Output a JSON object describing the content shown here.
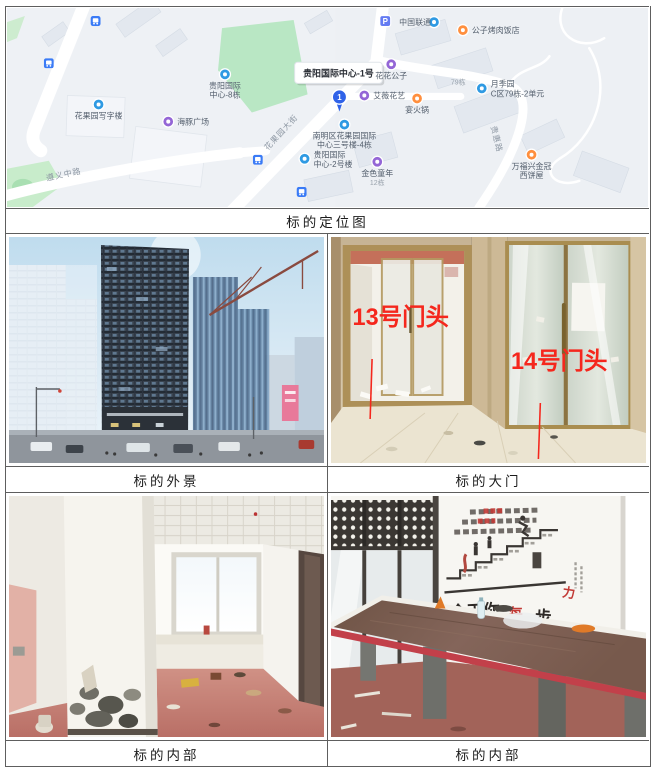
{
  "captions": {
    "map": "标的定位图",
    "exterior": "标的外景",
    "gate": "标的大门",
    "interior_left": "标的内部",
    "interior_right": "标的内部"
  },
  "map": {
    "main_label": "贵阳国际中心-1号",
    "pin_number": "1",
    "roads": {
      "zunyi": "遵义中路",
      "huaguoyuan": "花果园大街",
      "guihui": "贵惠路"
    },
    "pois": {
      "unicom": "中国联通",
      "parking": "P",
      "bbq": "公子烤肉饭店",
      "huahua": "花花公子",
      "florist": "艾薇花艺",
      "hotpot": "宴火锅",
      "yueji_line1": "月季园",
      "yueji_line2": "C区79栋-2单元",
      "block79": "79栋",
      "intl8_line1": "贵阳国际",
      "intl8_line2": "中心-8栋",
      "office": "花果园写字楼",
      "dolphin": "海豚广场",
      "nanming_line1": "南明区花果园国际",
      "nanming_line2": "中心三号楼-4栋",
      "intl2_line1": "贵阳国际",
      "intl2_line2": "中心-2号楼",
      "golden": "金色童年",
      "block12": "12栋",
      "bakery_line1": "万福兴金冠",
      "bakery_line2": "西饼屋"
    }
  },
  "gate": {
    "door13": "13号门头",
    "door14": "14号门头"
  },
  "meeting": {
    "slogan_main": "今天你",
    "slogan_mid": "每",
    "slogan_step": "步",
    "slogan_power": "力"
  },
  "colors": {
    "annotation_red": "#f5271d",
    "map_pin_blue": "#2f62e8"
  }
}
